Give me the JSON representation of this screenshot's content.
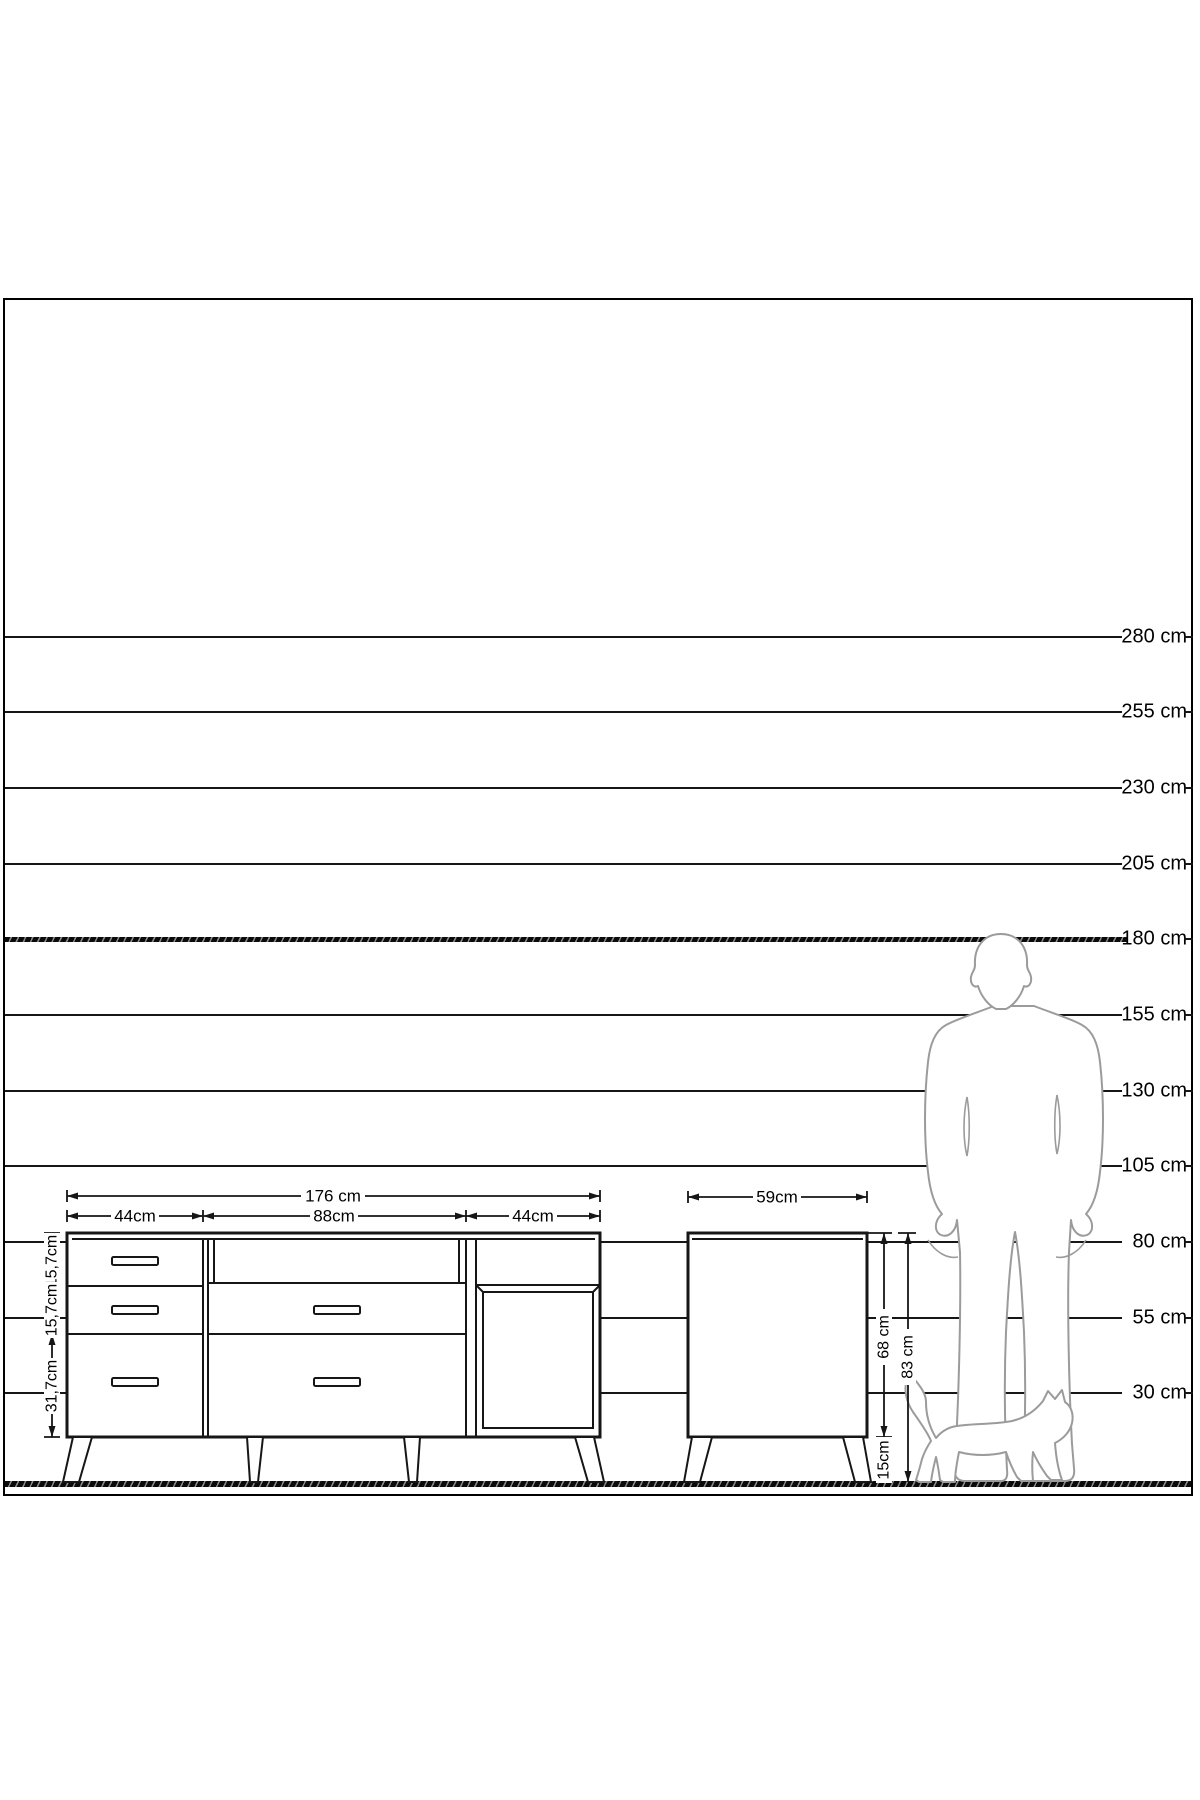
{
  "page": {
    "background": "#ffffff",
    "frame_border": "#000000",
    "line_color": "#161616",
    "figure_outline": "#9b9b9b"
  },
  "height_scale": {
    "ground_y": 1484,
    "px_per_cm": 3.0255,
    "line_start_x": 5,
    "line_end_x": 1122,
    "labels": [
      {
        "cm": 280,
        "text": "280 cm"
      },
      {
        "cm": 255,
        "text": "255 cm"
      },
      {
        "cm": 230,
        "text": "230 cm"
      },
      {
        "cm": 205,
        "text": "205 cm"
      },
      {
        "cm": 180,
        "text": "180 cm",
        "bold": true
      },
      {
        "cm": 155,
        "text": "155 cm"
      },
      {
        "cm": 130,
        "text": "130 cm"
      },
      {
        "cm": 105,
        "text": "105 cm"
      },
      {
        "cm": 80,
        "text": "80 cm"
      },
      {
        "cm": 55,
        "text": "55 cm"
      },
      {
        "cm": 30,
        "text": "30 cm"
      }
    ]
  },
  "front_view": {
    "total_width": "176 cm",
    "sections": [
      "44cm",
      "88cm",
      "44cm"
    ],
    "rows": [
      "15,7cm",
      "15,7cm",
      "31,7cm"
    ]
  },
  "side_view": {
    "depth": "59cm",
    "body_height": "68 cm",
    "total_height": "83 cm",
    "leg_height": "15cm"
  },
  "figures": {
    "man": "standing-man-silhouette",
    "cat": "walking-cat-silhouette"
  }
}
